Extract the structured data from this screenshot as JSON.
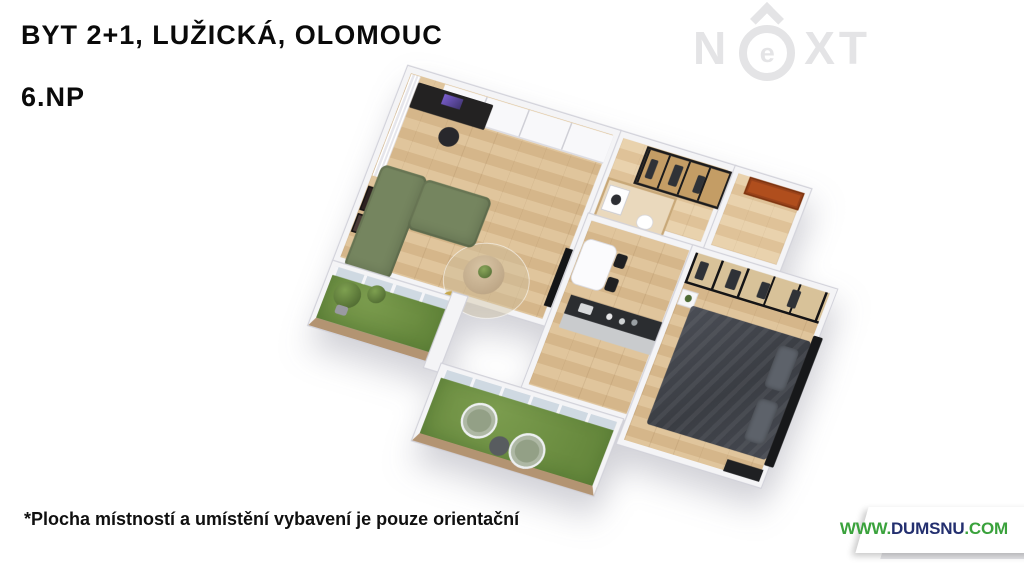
{
  "header": {
    "title": "BYT 2+1, LUŽICKÁ, OLOMOUC",
    "floor_label": "6.NP"
  },
  "watermark": {
    "n": "N",
    "e": "e",
    "xt": "XT",
    "color": "#e4e4e6"
  },
  "footer": {
    "disclaimer": "*Plocha místností a umístění vybavení je pouze orientační"
  },
  "website_badge": {
    "www": "WWW.",
    "name": "DUMSNU",
    "tld": ".COM",
    "green": "#3aa23c",
    "navy": "#232f6f",
    "ribbon_bg": "#ffffff"
  },
  "floorplan": {
    "view": "3d-axonometric-render",
    "colors": {
      "wood_floor": "#d9b98c",
      "hall_floor": "#e3cba4",
      "grass": "#6f9347",
      "walls": "#f4f4f6",
      "sofa_green": "#75855f",
      "bed_dark": "#3e4147",
      "entry_door_orange": "#b04e1d",
      "island_top": "#2b2d30",
      "balcony_rim_wood": "#b39472",
      "closet_frame": "#1b1b1d"
    },
    "rooms": [
      {
        "id": "living-room",
        "floor": "wood",
        "furniture": [
          "white-wardrobe-wall",
          "curtains",
          "black-desk-with-monitor",
          "office-chair",
          "wall-art-frames",
          "green-corner-sofa",
          "round-rug",
          "coffee-table-with-plant",
          "yellow-pouf",
          "tv-panel"
        ]
      },
      {
        "id": "kitchen-dining",
        "floor": "wood",
        "furniture": [
          "kitchen-island-dark-top",
          "sink",
          "white-dining-table",
          "black-dining-chairs"
        ]
      },
      {
        "id": "hallway",
        "floor": "wood",
        "furniture": [
          "walk-in-wardrobe-glass-black-frame",
          "hanging-clothes"
        ]
      },
      {
        "id": "bathroom",
        "floor": "wood",
        "furniture": [
          "washing-machine",
          "toilet"
        ]
      },
      {
        "id": "entry",
        "floor": "wood",
        "furniture": [
          "orange-entrance-door"
        ]
      },
      {
        "id": "bedroom",
        "floor": "wood",
        "furniture": [
          "glass-wardrobe-wall-black-frame",
          "double-bed-dark-duvet",
          "pillows",
          "black-headboard",
          "nightstand-with-plant",
          "dark-dresser"
        ]
      },
      {
        "id": "balcony-left",
        "floor": "artificial-grass",
        "furniture": [
          "potted-plant-large",
          "potted-plant-small"
        ]
      },
      {
        "id": "balcony-bottom",
        "floor": "artificial-grass",
        "furniture": [
          "wicker-chair",
          "wicker-chair",
          "round-side-table"
        ]
      }
    ]
  }
}
